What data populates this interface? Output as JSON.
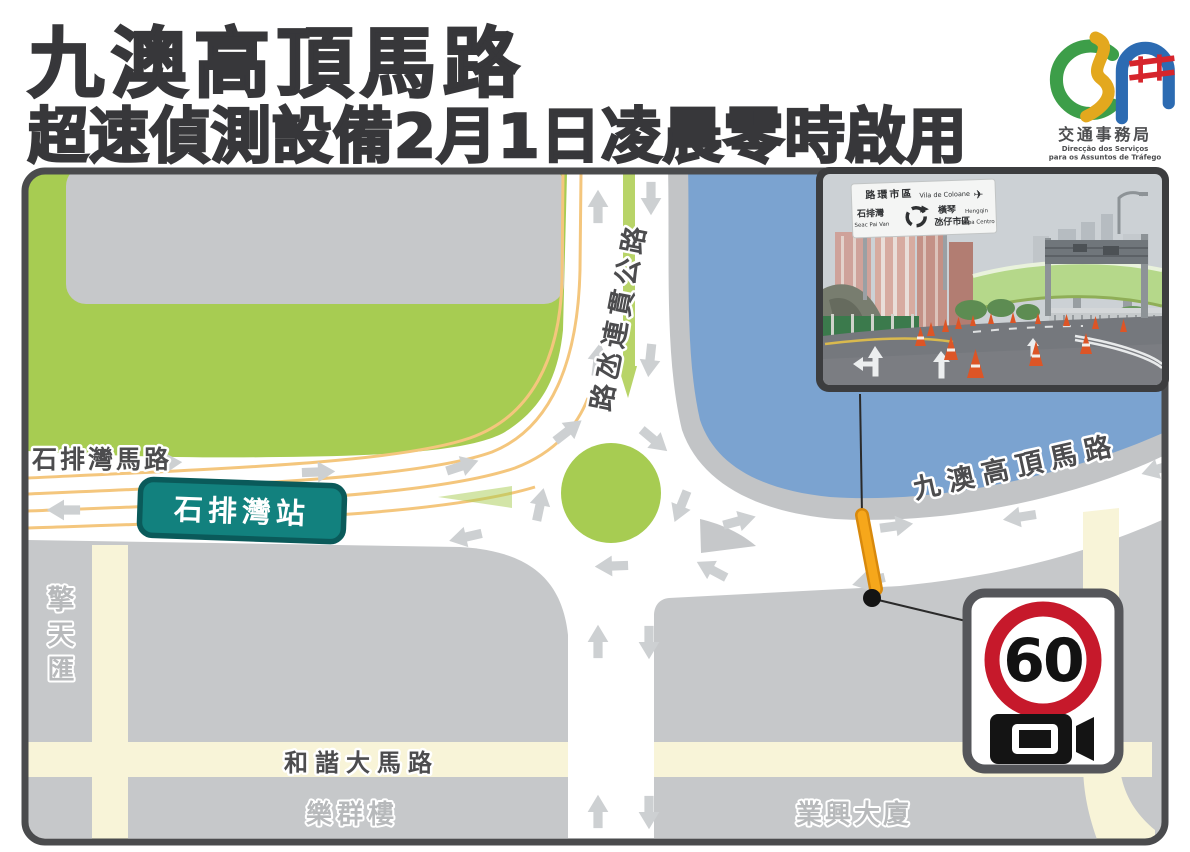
{
  "header": {
    "title_line1": "九澳高頂馬路",
    "title_line2": "超速偵測設備2月1日凌晨零時啟用"
  },
  "logo": {
    "agency_zh": "交通事務局",
    "agency_pt_1": "Direcção  dos  Serviços",
    "agency_pt_2": "para os Assuntos de Tráfego"
  },
  "map": {
    "road_labels": {
      "seac_pai_van_road": "石排灣馬路",
      "cotai_highway": "路氹連貫公路",
      "ka_ho_alto_road": "九澳高頂馬路",
      "harmony_avenue": "和諧大馬路"
    },
    "place_labels": {
      "station": "石排灣站",
      "king_tin_wui": "擎天匯",
      "lok_kuan_building": "樂群樓",
      "yip_heng_building": "業興大廈"
    },
    "speed_camera_sign": {
      "speed_limit": "60"
    },
    "colors": {
      "park_green": "#a7cc52",
      "water_blue": "#7ba3d0",
      "block_gray": "#c6c8ca",
      "minor_road_yellow": "#f8f4d8",
      "lane_line_orange": "#f4c67d",
      "station_teal": "#12817e",
      "camera_marker_orange": "#f6a71b",
      "sign_red": "#c6192b"
    }
  },
  "photo": {
    "gantry_sign": {
      "top_zh": "路環市區",
      "top_pt": "Vila de Coloane",
      "left_zh": "石排灣",
      "left_pt": "Seac Pai Van",
      "right_zh_1": "橫琴",
      "right_zh_2": "氹仔市區",
      "right_pt_1": "Hengqin",
      "right_pt_2": "Taipa Centro"
    }
  }
}
